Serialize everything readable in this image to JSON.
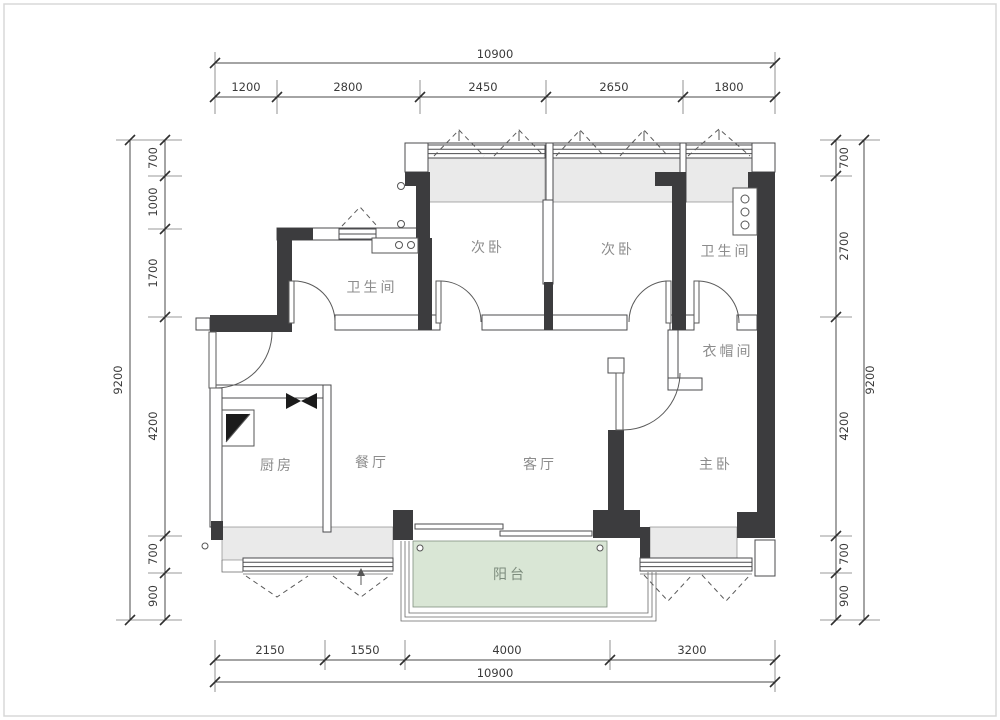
{
  "plan": {
    "title": "apartment-floor-plan",
    "rooms": {
      "bathroom_left": "卫生间",
      "bedroom_left": "次卧",
      "bedroom_middle": "次卧",
      "bathroom_right": "卫生间",
      "closet": "衣帽间",
      "kitchen": "厨房",
      "dining": "餐厅",
      "living": "客厅",
      "master": "主卧",
      "balcony": "阳台"
    },
    "dimensions": {
      "top": {
        "total": "10900",
        "segments": [
          "1200",
          "2800",
          "2450",
          "2650",
          "1800"
        ]
      },
      "bottom": {
        "total": "10900",
        "segments": [
          "2150",
          "1550",
          "4000",
          "3200"
        ]
      },
      "left": {
        "total": "9200",
        "segments": [
          "700",
          "1000",
          "1700",
          "4200",
          "700",
          "900"
        ]
      },
      "right": {
        "total": "9200",
        "segments": [
          "700",
          "2700",
          "4200",
          "700",
          "900"
        ]
      }
    },
    "colors": {
      "wall_dark": "#3c3c3e",
      "bay_fill": "#eaeaea",
      "balcony_fill": "#d9e6d5",
      "room_label": "#8c8c8c",
      "dim_text": "#3a3a3a"
    }
  }
}
